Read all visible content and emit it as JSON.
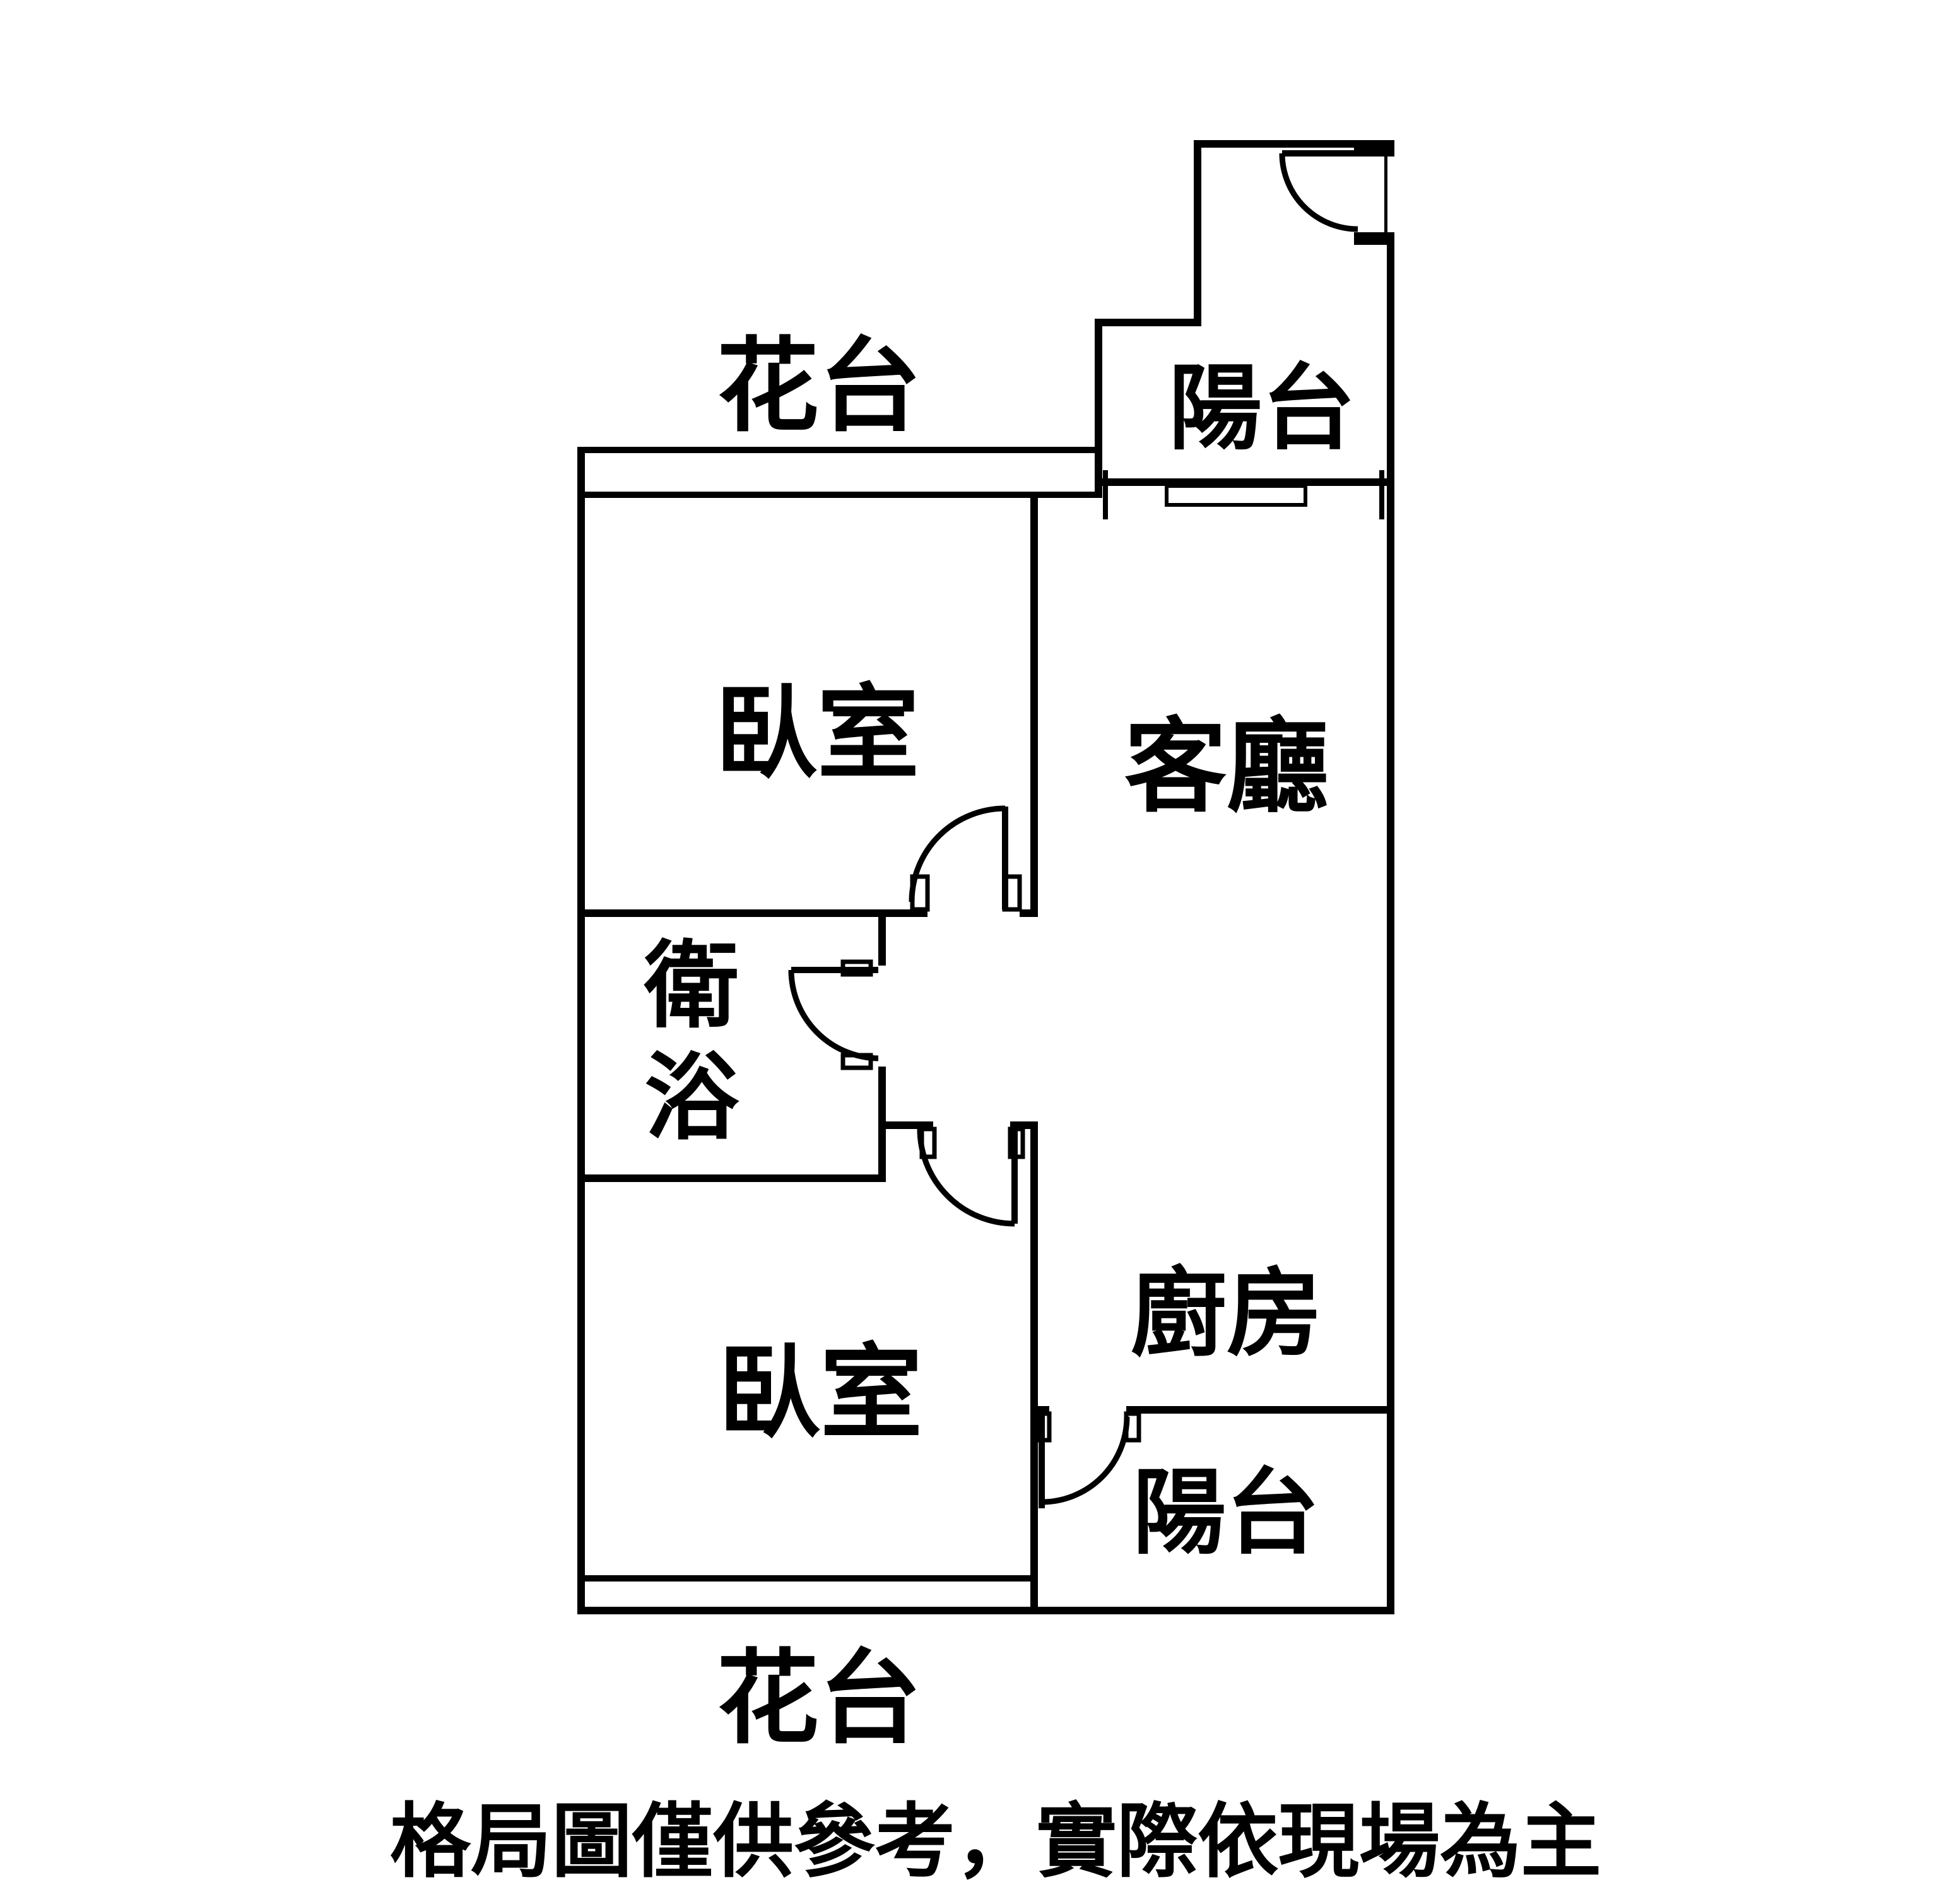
{
  "page": {
    "background_color": "#ffffff",
    "line_color": "#000000",
    "type": "apartment-floor-plan"
  },
  "plan": {
    "labels": {
      "flower_terrace_top": "花台",
      "balcony_top": "陽台",
      "bedroom_top": "臥室",
      "living_room": "客廳",
      "bathroom_char_1": "衛",
      "bathroom_char_2": "浴",
      "kitchen": "廚房",
      "bedroom_bottom": "臥室",
      "balcony_bottom": "陽台",
      "flower_terrace_bottom": "花台"
    },
    "caption": "格局圖僅供參考，實際依現場為主"
  }
}
